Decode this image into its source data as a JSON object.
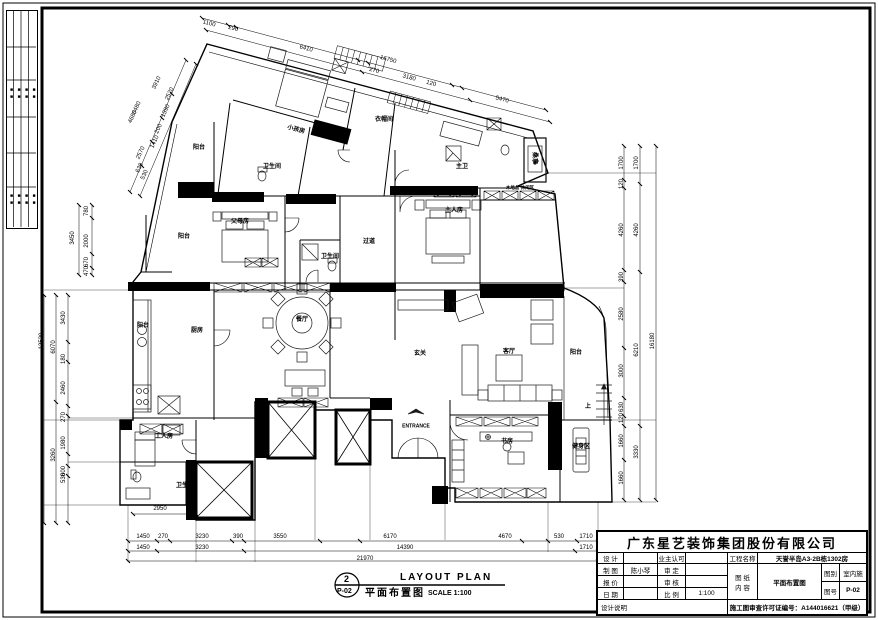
{
  "plan_callout": {
    "number": "2",
    "sheet_ref": "P-02",
    "title_cn": "平面布置图",
    "title_en": "LAYOUT PLAN",
    "scale": "SCALE 1:100"
  },
  "title_block": {
    "company": "广东星艺装饰集团股份有限公司",
    "design_label": "设 计",
    "owner_label": "业主认可",
    "project_label": "工程名称",
    "project_value": "天誉半岛A3-2B栋1302房",
    "draft_label": "制 图",
    "draft_value": "陈小琴",
    "approve_label": "审 定",
    "sheet_label": "图 纸",
    "content_label": "内 容",
    "content_value": "平面布置图",
    "cat_label": "图别",
    "cat_value": "室内施",
    "no_label": "图号",
    "no_value": "P-02",
    "quote_label": "报 价",
    "check_label": "审 核",
    "date_label": "日 期",
    "scale_label": "比 例",
    "scale_value": "1:100",
    "note_label": "设计说明",
    "permit": "施工图审查许可证编号：A144016621（甲级）"
  },
  "stamp_strip": {
    "cells": [
      "■■",
      "■■",
      "■■",
      "■■",
      "■■",
      "■■",
      "■■",
      "■■"
    ]
  },
  "plan": {
    "rooms": [
      {
        "t": "小孩房",
        "x": 296,
        "y": 130,
        "r": 15
      },
      {
        "t": "阳台",
        "x": 199,
        "y": 148
      },
      {
        "t": "卫生间",
        "x": 272,
        "y": 167
      },
      {
        "t": "衣帽间",
        "x": 384,
        "y": 120
      },
      {
        "t": "主卫",
        "x": 462,
        "y": 167
      },
      {
        "t": "桑拿",
        "x": 534,
        "y": 158,
        "r": 90
      },
      {
        "t": "主人房",
        "x": 454,
        "y": 211
      },
      {
        "t": "木地台 休闲区",
        "x": 520,
        "y": 188,
        "s": 4.5
      },
      {
        "t": "父母房",
        "x": 240,
        "y": 222
      },
      {
        "t": "阳台",
        "x": 184,
        "y": 237
      },
      {
        "t": "过道",
        "x": 369,
        "y": 242
      },
      {
        "t": "卫生间",
        "x": 330,
        "y": 257
      },
      {
        "t": "厨房",
        "x": 197,
        "y": 331
      },
      {
        "t": "阳台",
        "x": 143,
        "y": 326
      },
      {
        "t": "餐厅",
        "x": 302,
        "y": 320
      },
      {
        "t": "玄关",
        "x": 420,
        "y": 354
      },
      {
        "t": "客厅",
        "x": 509,
        "y": 352
      },
      {
        "t": "阳台",
        "x": 576,
        "y": 353
      },
      {
        "t": "ENTRANCE",
        "x": 416,
        "y": 427,
        "s": 5
      },
      {
        "t": "工人房",
        "x": 164,
        "y": 437
      },
      {
        "t": "卫生间",
        "x": 185,
        "y": 486
      },
      {
        "t": "书房",
        "x": 507,
        "y": 442
      },
      {
        "t": "健身区",
        "x": 581,
        "y": 447
      },
      {
        "t": "上",
        "x": 588,
        "y": 407
      }
    ],
    "dims": [
      {
        "t": "1100",
        "x": 209,
        "y": 24,
        "r": 15
      },
      {
        "t": "290",
        "x": 233,
        "y": 29,
        "r": 15
      },
      {
        "t": "6410",
        "x": 306,
        "y": 49,
        "r": 15
      },
      {
        "t": "16750",
        "x": 388,
        "y": 60,
        "r": 15
      },
      {
        "t": "270",
        "x": 374,
        "y": 71,
        "r": 15
      },
      {
        "t": "3180",
        "x": 409,
        "y": 78,
        "r": 15
      },
      {
        "t": "120",
        "x": 431,
        "y": 84,
        "r": 15
      },
      {
        "t": "5470",
        "x": 502,
        "y": 100,
        "r": 15
      },
      {
        "t": "4680",
        "x": 133,
        "y": 117,
        "r": -65
      },
      {
        "t": "3910",
        "x": 157,
        "y": 83,
        "r": -65
      },
      {
        "t": "2520",
        "x": 170,
        "y": 94,
        "r": -65
      },
      {
        "t": "6480",
        "x": 137,
        "y": 108,
        "r": -65
      },
      {
        "t": "1390",
        "x": 166,
        "y": 111,
        "r": -65
      },
      {
        "t": "200",
        "x": 159,
        "y": 129,
        "r": -65
      },
      {
        "t": "1410",
        "x": 155,
        "y": 142,
        "r": -65
      },
      {
        "t": "2570",
        "x": 141,
        "y": 153,
        "r": -65
      },
      {
        "t": "630",
        "x": 140,
        "y": 168,
        "r": -65
      },
      {
        "t": "530",
        "x": 145,
        "y": 175,
        "r": -65
      },
      {
        "t": "780",
        "x": 87,
        "y": 211,
        "r": -90
      },
      {
        "t": "3450",
        "x": 73,
        "y": 238,
        "r": -90
      },
      {
        "t": "2000",
        "x": 87,
        "y": 241,
        "r": -90
      },
      {
        "t": "670",
        "x": 87,
        "y": 262,
        "r": -90
      },
      {
        "t": "470",
        "x": 87,
        "y": 271,
        "r": -90
      },
      {
        "t": "13520",
        "x": 42,
        "y": 341,
        "r": -90
      },
      {
        "t": "6070",
        "x": 54,
        "y": 347,
        "r": -90
      },
      {
        "t": "3430",
        "x": 64,
        "y": 318,
        "r": -90
      },
      {
        "t": "180",
        "x": 64,
        "y": 359,
        "r": -90
      },
      {
        "t": "2460",
        "x": 64,
        "y": 388,
        "r": -90
      },
      {
        "t": "270",
        "x": 64,
        "y": 417,
        "r": -90
      },
      {
        "t": "1980",
        "x": 64,
        "y": 443,
        "r": -90
      },
      {
        "t": "3260",
        "x": 54,
        "y": 455,
        "r": -90
      },
      {
        "t": "600",
        "x": 64,
        "y": 471,
        "r": -90
      },
      {
        "t": "530",
        "x": 64,
        "y": 478,
        "r": -90
      },
      {
        "t": "1700",
        "x": 622,
        "y": 163,
        "r": -90
      },
      {
        "t": "1700",
        "x": 637,
        "y": 163,
        "r": -90
      },
      {
        "t": "120",
        "x": 622,
        "y": 184,
        "r": -90
      },
      {
        "t": "4260",
        "x": 622,
        "y": 230,
        "r": -90
      },
      {
        "t": "4260",
        "x": 637,
        "y": 230,
        "r": -90
      },
      {
        "t": "390",
        "x": 622,
        "y": 277,
        "r": -90
      },
      {
        "t": "2580",
        "x": 622,
        "y": 314,
        "r": -90
      },
      {
        "t": "16180",
        "x": 653,
        "y": 341,
        "r": -90
      },
      {
        "t": "6210",
        "x": 637,
        "y": 350,
        "r": -90
      },
      {
        "t": "3000",
        "x": 622,
        "y": 371,
        "r": -90
      },
      {
        "t": "630",
        "x": 622,
        "y": 407,
        "r": -90
      },
      {
        "t": "120",
        "x": 622,
        "y": 418,
        "r": -90
      },
      {
        "t": "1660",
        "x": 622,
        "y": 441,
        "r": -90
      },
      {
        "t": "3330",
        "x": 637,
        "y": 452,
        "r": -90
      },
      {
        "t": "1660",
        "x": 622,
        "y": 478,
        "r": -90
      },
      {
        "t": "1450",
        "x": 143,
        "y": 537
      },
      {
        "t": "270",
        "x": 163,
        "y": 537
      },
      {
        "t": "3230",
        "x": 202,
        "y": 537
      },
      {
        "t": "390",
        "x": 238,
        "y": 537
      },
      {
        "t": "3550",
        "x": 280,
        "y": 537
      },
      {
        "t": "6170",
        "x": 390,
        "y": 537
      },
      {
        "t": "4670",
        "x": 505,
        "y": 537
      },
      {
        "t": "530",
        "x": 559,
        "y": 537
      },
      {
        "t": "1710",
        "x": 586,
        "y": 537
      },
      {
        "t": "1450",
        "x": 143,
        "y": 548
      },
      {
        "t": "3230",
        "x": 202,
        "y": 548
      },
      {
        "t": "14390",
        "x": 405,
        "y": 548
      },
      {
        "t": "1710",
        "x": 586,
        "y": 548
      },
      {
        "t": "21970",
        "x": 365,
        "y": 559
      },
      {
        "t": "2950",
        "x": 160,
        "y": 509
      }
    ]
  }
}
